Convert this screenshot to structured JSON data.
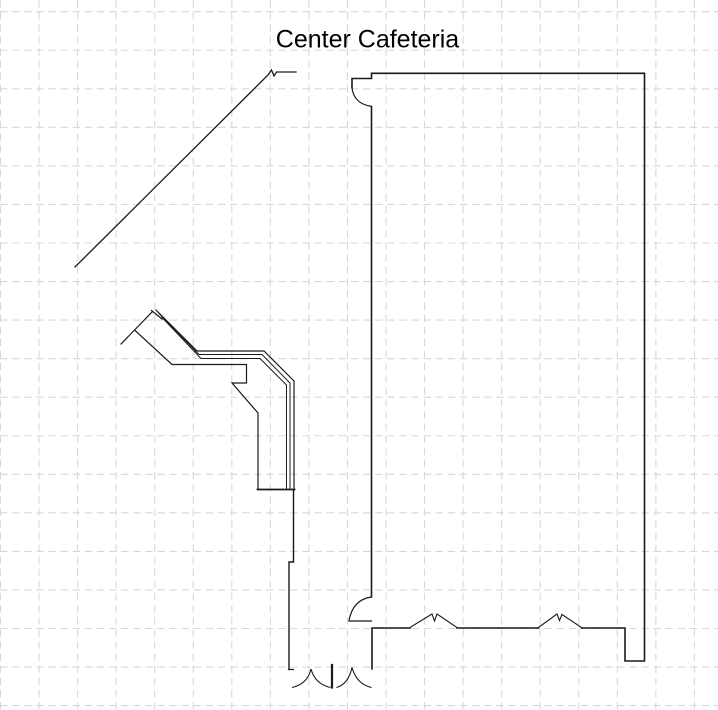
{
  "title": "Center Cafeteria",
  "colors": {
    "background": "#ffffff",
    "line": "#1a1a1a",
    "grid": "#d8d8d8"
  },
  "canvas": {
    "width": 718,
    "height": 710
  },
  "grid": {
    "spacing": 38.55,
    "offset_x": 0.5,
    "offset_y": 11.7,
    "dash": "7.5 4.6",
    "stroke_width": 1.1
  },
  "floorplan": {
    "title_pos": {
      "x": 367.5,
      "y": 47.5
    },
    "polylines": [
      {
        "name": "wall-main-room-top-right",
        "w": 1.6,
        "pts": [
          [
            352,
            87.5
          ],
          [
            352,
            78.5
          ],
          [
            371.5,
            78.5
          ],
          [
            371.5,
            73.3
          ],
          [
            644.5,
            73.3
          ],
          [
            644.5,
            661
          ],
          [
            625,
            661
          ],
          [
            625,
            628
          ],
          [
            581.5,
            628
          ]
        ]
      },
      {
        "name": "wall-main-room-bottom-mid",
        "w": 1.6,
        "pts": [
          [
            538.5,
            628
          ],
          [
            457,
            628
          ]
        ]
      },
      {
        "name": "wall-main-room-bottom-corner",
        "w": 1.6,
        "pts": [
          [
            410,
            628
          ],
          [
            372,
            628
          ],
          [
            372,
            669
          ]
        ]
      },
      {
        "name": "wall-main-room-left",
        "w": 1.6,
        "pts": [
          [
            371.5,
            106.5
          ],
          [
            371.5,
            597
          ]
        ]
      },
      {
        "name": "door-leaf-bottom-left",
        "w": 1.2,
        "pts": [
          [
            349,
            621
          ],
          [
            371.5,
            621
          ]
        ]
      },
      {
        "name": "hall-wall-diagonal",
        "w": 1.3,
        "pts": [
          [
            75,
            267
          ],
          [
            268,
            75
          ],
          [
            271.5,
            70
          ],
          [
            274,
            76
          ],
          [
            276.5,
            72
          ],
          [
            296,
            72
          ]
        ]
      },
      {
        "name": "counter-end-diagonal",
        "w": 1.2,
        "pts": [
          [
            121,
            344
          ],
          [
            152.5,
            311.5
          ]
        ]
      },
      {
        "name": "counter-end-cap",
        "w": 1.2,
        "pts": [
          [
            151.5,
            310.5
          ],
          [
            162,
            319
          ]
        ]
      },
      {
        "name": "counter-rail-outer",
        "w": 1.2,
        "pts": [
          [
            156,
            310
          ],
          [
            197,
            351
          ],
          [
            264,
            351
          ],
          [
            294,
            381
          ],
          [
            294,
            490
          ]
        ]
      },
      {
        "name": "counter-rail-middle",
        "w": 1,
        "pts": [
          [
            159,
            313.5
          ],
          [
            199,
            354.5
          ],
          [
            262,
            354.5
          ],
          [
            290,
            383
          ],
          [
            290,
            489
          ]
        ]
      },
      {
        "name": "counter-rail-inner",
        "w": 1,
        "pts": [
          [
            162,
            317.5
          ],
          [
            201,
            358.5
          ],
          [
            260,
            358.5
          ],
          [
            286.5,
            385
          ],
          [
            286.5,
            489
          ]
        ]
      },
      {
        "name": "counter-body-outline",
        "w": 1.2,
        "pts": [
          [
            135,
            330.5
          ],
          [
            172,
            364.5
          ],
          [
            246.5,
            364.5
          ],
          [
            246.5,
            383
          ],
          [
            232,
            383
          ],
          [
            258,
            413
          ],
          [
            258,
            489
          ]
        ]
      },
      {
        "name": "counter-base-cap",
        "w": 1.8,
        "pts": [
          [
            257.5,
            489.5
          ],
          [
            294.5,
            489.5
          ]
        ]
      },
      {
        "name": "vestibule-wall-left",
        "w": 1.4,
        "pts": [
          [
            293.5,
            490
          ],
          [
            293.5,
            562
          ],
          [
            289,
            562
          ],
          [
            289,
            669
          ]
        ]
      },
      {
        "name": "wall-break-symbol-1",
        "w": 1.1,
        "pts": [
          [
            410,
            627.5
          ],
          [
            432,
            614
          ],
          [
            434.5,
            621
          ],
          [
            437,
            614
          ],
          [
            457,
            627.5
          ]
        ]
      },
      {
        "name": "wall-break-symbol-2",
        "w": 1.1,
        "pts": [
          [
            538.5,
            627.5
          ],
          [
            557,
            614
          ],
          [
            559.5,
            620.5
          ],
          [
            562,
            614.5
          ],
          [
            581.5,
            627.5
          ]
        ]
      },
      {
        "name": "door-post",
        "w": 2.2,
        "pts": [
          [
            332,
            665
          ],
          [
            332,
            687.5
          ]
        ]
      },
      {
        "name": "door-jamb-tick",
        "w": 1.2,
        "pts": [
          [
            288.5,
            669.5
          ],
          [
            293.5,
            669.5
          ]
        ]
      }
    ],
    "arcs": [
      {
        "name": "door-arc-top-left",
        "w": 1.2,
        "d": "M 352 87.5 Q 353.5 103.5 371.5 106.5"
      },
      {
        "name": "door-arc-bottom-left",
        "w": 1.2,
        "d": "M 371.5 597 Q 353 599.5 349 620.5"
      },
      {
        "name": "door-swing-arc-1a",
        "w": 1.1,
        "d": "M 292 687.5 Q 307.5 684 311 669"
      },
      {
        "name": "door-swing-arc-1b",
        "w": 1.1,
        "d": "M 311 669 Q 315 684 330.5 687.5"
      },
      {
        "name": "door-swing-arc-2a",
        "w": 1.1,
        "d": "M 336.5 687.5 Q 348.5 684 352 667.5"
      },
      {
        "name": "door-swing-arc-2b",
        "w": 1.1,
        "d": "M 352 667.5 Q 356.5 684 371.5 687.5"
      }
    ]
  }
}
